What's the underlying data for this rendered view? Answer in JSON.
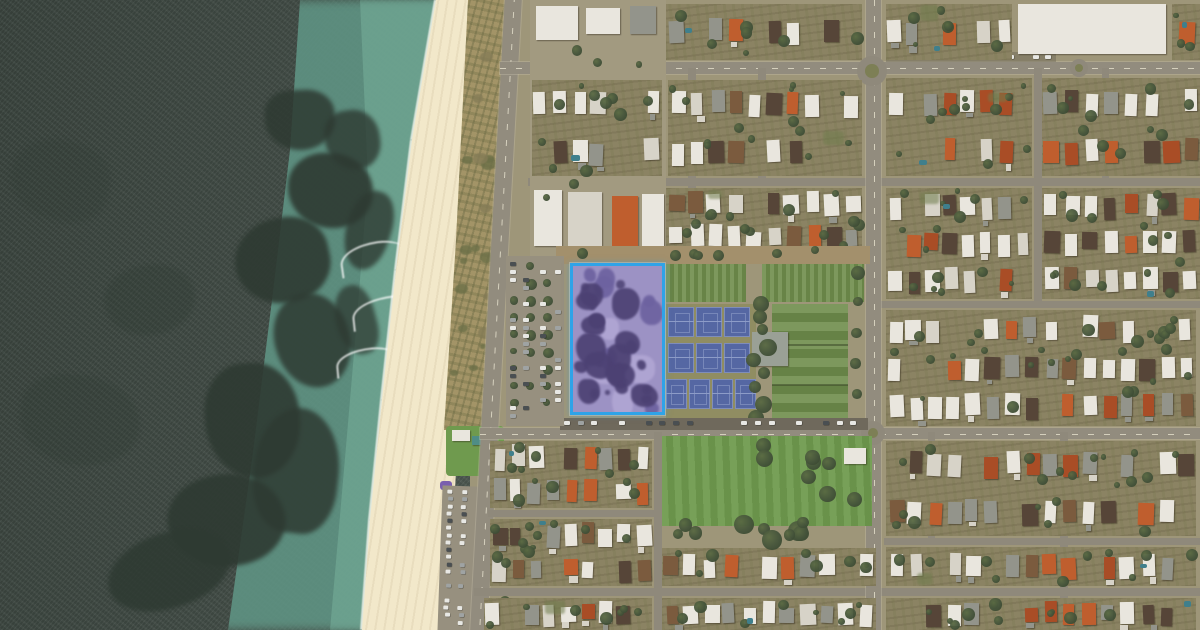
{
  "meta": {
    "type": "satellite-aerial-map",
    "description": "Aerial imagery of a beachside suburb: ocean with reef on the west, sandy beach and dunes, a coastal road, a street grid of houses, a tennis club with blue hard courts and grass courts, parks, and one highlighted land parcel outlined in blue between a car park and the tennis courts.",
    "visible_text": "none"
  },
  "canvas": {
    "width": 1200,
    "height": 630
  },
  "colors": {
    "ocean_deep": "#414b45",
    "ocean_shallow": "#5f9383",
    "ocean_bright": "#73ab97",
    "reef": "#2e3a32",
    "foam": "#eef2ea",
    "sand": "#eadfbe",
    "dune": "#a39467",
    "road": "#8f897b",
    "urban_base": "#9e9679",
    "yard": "#8b8363",
    "roof_white": "#e9e6de",
    "roof_offwhite": "#d7d3c8",
    "roof_terracotta": "#bf5e2e",
    "roof_terracotta_dark": "#a94d26",
    "roof_gray": "#93948b",
    "roof_dark": "#564538",
    "roof_brown": "#7b5b3e",
    "tree": "#44533a",
    "tree_dark": "#36442c",
    "tree_light": "#5a6a43",
    "grass_field": "#6e8c4b",
    "lawn": "#6f9a4e",
    "court_blue": "#5567a3",
    "court_line": "#8d9cc8",
    "court_surround": "#908d62",
    "dirt": "#a3906c",
    "parking": "#97907f",
    "parking_dark": "#6f695c",
    "clubhouse": "#9aa096",
    "car_white": "#e8e8e4",
    "car_gray": "#9fa3a3",
    "car_dark": "#4a4f52",
    "pool": "#3f7f8c",
    "kiosk_teal": "#4f8d86",
    "playground_shade": "#7a5fae",
    "parcel_fill": "#9c92c4",
    "parcel_tree_blob": "#4c4173",
    "parcel_tree_blob2": "#6d62a0",
    "parcel_light": "#b7acd8",
    "parcel_border": "#2fa3e8"
  },
  "parcel": {
    "x": 570,
    "y": 263,
    "width": 95,
    "height": 152,
    "border_width": 3,
    "blob_count": 26,
    "small_blob_count": 10,
    "light_patch_count": 4
  },
  "shoreline_points": [
    [
      436,
      0
    ],
    [
      412,
      140
    ],
    [
      396,
      270
    ],
    [
      382,
      400
    ],
    [
      370,
      520
    ],
    [
      362,
      630
    ]
  ],
  "reef_blobs": [
    [
      300,
      120,
      70,
      60,
      0.85
    ],
    [
      330,
      190,
      85,
      75,
      0.9
    ],
    [
      282,
      260,
      95,
      85,
      0.9
    ],
    [
      312,
      340,
      75,
      95,
      0.85
    ],
    [
      252,
      420,
      95,
      115,
      0.9
    ],
    [
      296,
      470,
      85,
      125,
      0.85
    ],
    [
      226,
      520,
      115,
      95,
      0.9
    ],
    [
      168,
      570,
      125,
      75,
      0.85
    ],
    [
      352,
      140,
      55,
      60,
      0.8
    ],
    [
      368,
      230,
      45,
      80,
      0.8
    ],
    [
      356,
      320,
      40,
      70,
      0.75
    ],
    [
      150,
      300,
      90,
      70,
      0.3
    ],
    [
      80,
      420,
      120,
      90,
      0.25
    ],
    [
      60,
      180,
      100,
      80,
      0.2
    ]
  ],
  "waves": [
    [
      340,
      242,
      64,
      30,
      -8
    ],
    [
      352,
      296,
      72,
      30,
      -6
    ],
    [
      336,
      348,
      60,
      26,
      -5
    ]
  ],
  "roads": {
    "coastal": {
      "x1": 513,
      "y1": -4,
      "x2": 478,
      "y2": 634,
      "w": 17
    },
    "h_streets": [
      {
        "x": 500,
        "y": 62,
        "w": 700,
        "h": 12,
        "main": true
      },
      {
        "x": 528,
        "y": 178,
        "w": 672,
        "h": 8
      },
      {
        "x": 874,
        "y": 301,
        "w": 326,
        "h": 7
      },
      {
        "x": 480,
        "y": 428,
        "w": 720,
        "h": 11,
        "main": true
      },
      {
        "x": 488,
        "y": 510,
        "w": 172,
        "h": 7
      },
      {
        "x": 884,
        "y": 538,
        "w": 316,
        "h": 7
      },
      {
        "x": 474,
        "y": 588,
        "w": 726,
        "h": 8
      }
    ],
    "v_streets": [
      {
        "x": 866,
        "y": 0,
        "w": 15,
        "h": 630,
        "main": true
      },
      {
        "x": 688,
        "y": 68,
        "w": 8,
        "h": 190
      },
      {
        "x": 758,
        "y": 68,
        "w": 8,
        "h": 112
      },
      {
        "x": 1034,
        "y": 68,
        "w": 8,
        "h": 236
      },
      {
        "x": 1102,
        "y": 68,
        "w": 7,
        "h": 112
      },
      {
        "x": 654,
        "y": 432,
        "w": 8,
        "h": 198
      },
      {
        "x": 928,
        "y": 432,
        "w": 7,
        "h": 108
      },
      {
        "x": 1060,
        "y": 432,
        "w": 8,
        "h": 198
      }
    ],
    "roundabouts": [
      {
        "cx": 872,
        "cy": 71,
        "r": 15
      },
      {
        "cx": 873,
        "cy": 433,
        "r": 12
      },
      {
        "cx": 1079,
        "cy": 68,
        "r": 9
      }
    ]
  },
  "residential_blocks": [
    {
      "x": 666,
      "y": 4,
      "w": 196,
      "h": 56
    },
    {
      "x": 886,
      "y": 4,
      "w": 126,
      "h": 56
    },
    {
      "x": 1172,
      "y": 4,
      "w": 28,
      "h": 56
    },
    {
      "x": 532,
      "y": 80,
      "w": 130,
      "h": 96
    },
    {
      "x": 668,
      "y": 80,
      "w": 194,
      "h": 96
    },
    {
      "x": 886,
      "y": 78,
      "w": 146,
      "h": 98
    },
    {
      "x": 1042,
      "y": 78,
      "w": 158,
      "h": 98
    },
    {
      "x": 666,
      "y": 188,
      "w": 196,
      "h": 66
    },
    {
      "x": 886,
      "y": 188,
      "w": 146,
      "h": 111
    },
    {
      "x": 1042,
      "y": 188,
      "w": 158,
      "h": 111
    },
    {
      "x": 886,
      "y": 310,
      "w": 310,
      "h": 116
    },
    {
      "x": 490,
      "y": 441,
      "w": 162,
      "h": 67
    },
    {
      "x": 490,
      "y": 519,
      "w": 162,
      "h": 67
    },
    {
      "x": 484,
      "y": 598,
      "w": 168,
      "h": 32
    },
    {
      "x": 662,
      "y": 548,
      "w": 214,
      "h": 38
    },
    {
      "x": 662,
      "y": 598,
      "w": 214,
      "h": 32
    },
    {
      "x": 886,
      "y": 441,
      "w": 310,
      "h": 95
    },
    {
      "x": 886,
      "y": 547,
      "w": 310,
      "h": 39
    },
    {
      "x": 886,
      "y": 598,
      "w": 310,
      "h": 32
    }
  ],
  "commercial_zone": {
    "x": 530,
    "y": 0,
    "w": 136,
    "h": 258
  },
  "commercial_buildings": [
    {
      "x": 536,
      "y": 6,
      "w": 42,
      "h": 34,
      "c": "roof_white"
    },
    {
      "x": 586,
      "y": 8,
      "w": 34,
      "h": 26,
      "c": "roof_white"
    },
    {
      "x": 630,
      "y": 6,
      "w": 26,
      "h": 28,
      "c": "roof_gray"
    },
    {
      "x": 534,
      "y": 96,
      "w": 40,
      "h": 52,
      "c": "roof_white"
    },
    {
      "x": 592,
      "y": 98,
      "w": 48,
      "h": 46,
      "c": "roof_white"
    },
    {
      "x": 534,
      "y": 190,
      "w": 28,
      "h": 56,
      "c": "roof_white"
    },
    {
      "x": 568,
      "y": 192,
      "w": 34,
      "h": 56,
      "c": "roof_offwhite"
    },
    {
      "x": 612,
      "y": 196,
      "w": 26,
      "h": 50,
      "c": "roof_terracotta"
    },
    {
      "x": 642,
      "y": 194,
      "w": 22,
      "h": 54,
      "c": "roof_white"
    },
    {
      "x": 1018,
      "y": 4,
      "w": 148,
      "h": 50,
      "c": "roof_white"
    }
  ],
  "sports_precinct": {
    "dirt_strip": {
      "x": 556,
      "y": 246,
      "w": 314,
      "h": 18,
      "trees": 7
    },
    "grass_top_left": {
      "x": 666,
      "y": 264,
      "w": 80,
      "h": 38
    },
    "grass_top_right": {
      "x": 762,
      "y": 264,
      "w": 102,
      "h": 38
    },
    "hardcourt_surround": {
      "x": 666,
      "y": 304,
      "w": 90,
      "h": 120
    },
    "court_rows": [
      {
        "x": 668,
        "y": 307,
        "n": 3,
        "w": 26,
        "h": 30,
        "gap": 2
      },
      {
        "x": 668,
        "y": 343,
        "n": 3,
        "w": 26,
        "h": 30,
        "gap": 2
      },
      {
        "x": 666,
        "y": 379,
        "n": 4,
        "w": 21,
        "h": 30,
        "gap": 2
      }
    ],
    "grass_courts": {
      "x": 772,
      "y": 304,
      "w": 76,
      "h": 120,
      "bands": 3
    },
    "clubhouse": {
      "x": 752,
      "y": 332,
      "w": 36,
      "h": 34
    },
    "tree_column": {
      "x": 744,
      "y": 296,
      "w": 28,
      "h": 128,
      "n": 9
    },
    "east_trees": {
      "x": 848,
      "y": 266,
      "w": 18,
      "h": 154,
      "n": 5
    },
    "south_parking": {
      "x": 560,
      "y": 418,
      "w": 308,
      "h": 12,
      "cars": 22
    }
  },
  "west_parking": {
    "x": 506,
    "y": 256,
    "w": 58,
    "h": 170,
    "tree_cols": [
      514,
      530,
      547
    ],
    "car_cols": [
      510,
      523,
      540,
      555
    ],
    "tree_n": 9
  },
  "park": {
    "lawn": {
      "x": 662,
      "y": 436,
      "w": 210,
      "h": 90
    },
    "lawn_trees": 9,
    "band_trees": 11,
    "band": {
      "x": 662,
      "y": 512,
      "w": 150,
      "h": 38
    },
    "shed": {
      "x": 844,
      "y": 448,
      "w": 22,
      "h": 16
    }
  },
  "beach_amenity": {
    "lawn": {
      "x": 446,
      "y": 426,
      "w": 58,
      "h": 50
    },
    "kiosk_white": {
      "x": 452,
      "y": 430,
      "w": 18,
      "h": 11
    },
    "kiosk_teal": {
      "x": 472,
      "y": 436,
      "w": 12,
      "h": 9
    },
    "playground": {
      "x": 440,
      "y": 481,
      "w": 12,
      "h": 9
    },
    "beach_parking": {
      "x": 440,
      "y": 486,
      "w": 38,
      "h": 146,
      "rot": 2,
      "car_cols": [
        5,
        19
      ],
      "rows": 19
    },
    "edge_trees": 6
  },
  "extra_car_rows": [
    {
      "x": 604,
      "y": 66,
      "w": 52,
      "h": 12,
      "n": 7
    },
    {
      "x": 556,
      "y": 158,
      "w": 86,
      "h": 12,
      "n": 10
    },
    {
      "x": 886,
      "y": 52,
      "w": 170,
      "h": 10,
      "n": 14
    }
  ],
  "street_tree_rows": [
    {
      "x": 890,
      "y": 82,
      "n": 7,
      "dx": 26
    },
    {
      "x": 902,
      "y": 444,
      "n": 9,
      "dx": 32
    },
    {
      "x": 500,
      "y": 596,
      "n": 6,
      "dx": 4,
      "dy": 6,
      "vertical": false
    }
  ],
  "dune_scrub_blobs": 18,
  "render_params": {
    "lot_width": 19,
    "row_height": 40,
    "house_occupancy": 0.82,
    "seed": 1337
  }
}
